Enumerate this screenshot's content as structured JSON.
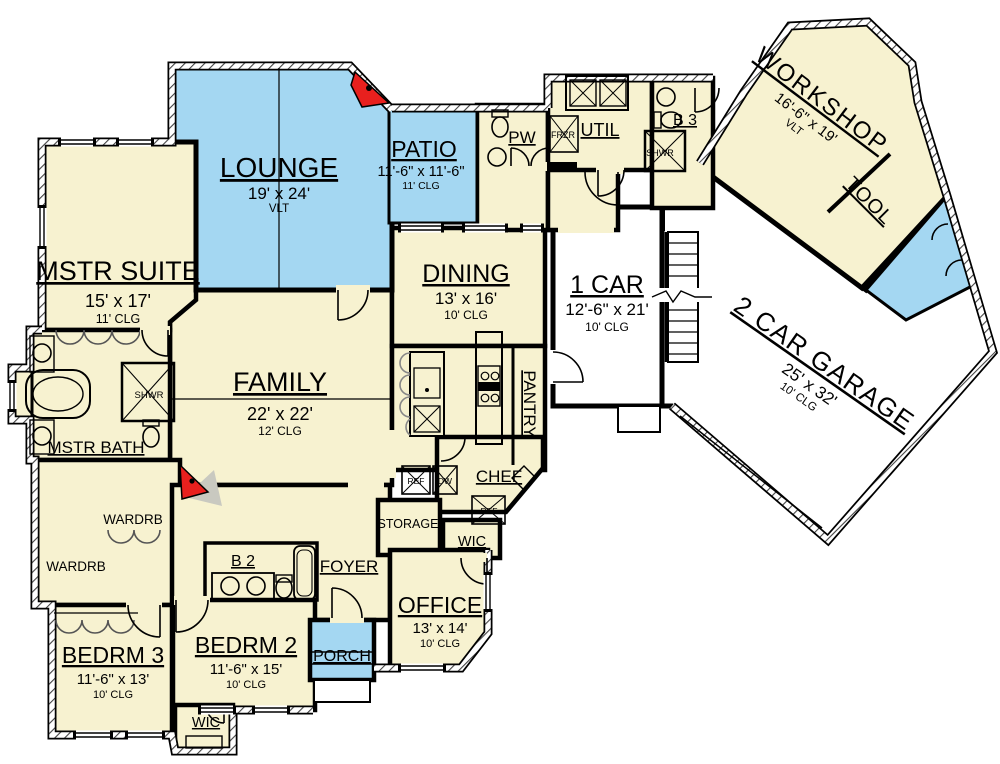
{
  "plan": {
    "title": "First floor plan",
    "rooms": {
      "mstr_suite": {
        "name": "MSTR SUITE",
        "dims": "15' x 17'",
        "clg": "11' CLG"
      },
      "lounge": {
        "name": "LOUNGE",
        "dims": "19' x 24'",
        "clg": "VLT"
      },
      "patio": {
        "name": "PATIO",
        "dims": "11'-6\" x 11'-6\"",
        "clg": "11' CLG"
      },
      "pw": {
        "name": "PW"
      },
      "util": {
        "name": "UTIL"
      },
      "b3": {
        "name": "B 3"
      },
      "shwr_b3": {
        "name": "SHWR"
      },
      "workshop": {
        "name": "WORKSHOP",
        "dims": "16'-6\" x 19'",
        "clg": "VLT"
      },
      "tool": {
        "name": "TOOL"
      },
      "one_car": {
        "name": "1 CAR",
        "dims": "12'-6\" x 21'",
        "clg": "10' CLG"
      },
      "garage": {
        "name": "2 CAR GARAGE",
        "dims": "25' x 32'",
        "clg": "10' CLG"
      },
      "dining": {
        "name": "DINING",
        "dims": "13' x 16'",
        "clg": "10' CLG"
      },
      "family": {
        "name": "FAMILY",
        "dims": "22' x 22'",
        "clg": "12' CLG"
      },
      "pantry": {
        "name": "PANTRY"
      },
      "chef": {
        "name": "CHEF"
      },
      "mstr_bath": {
        "name": "MSTR BATH"
      },
      "shwr_mstr": {
        "name": "SHWR"
      },
      "wardrb_upper": {
        "name": "WARDRB"
      },
      "wardrb_lower": {
        "name": "WARDRB"
      },
      "storage": {
        "name": "STORAGE"
      },
      "wic_office": {
        "name": "WIC"
      },
      "wic_bedrm2": {
        "name": "WIC"
      },
      "b2": {
        "name": "B 2"
      },
      "foyer": {
        "name": "FOYER"
      },
      "office": {
        "name": "OFFICE",
        "dims": "13' x 14'",
        "clg": "10' CLG"
      },
      "porch": {
        "name": "PORCH"
      },
      "bedrm3": {
        "name": "BEDRM 3",
        "dims": "11'-6\" x 13'",
        "clg": "10' CLG"
      },
      "bedrm2": {
        "name": "BEDRM 2",
        "dims": "11'-6\" x 15'",
        "clg": "10' CLG"
      }
    },
    "appliances": {
      "frzr": "FRZR",
      "ref_kitchen": "REF",
      "dw": "DW",
      "ref_chef": "REF"
    },
    "colors": {
      "room_fill": "#F7F2D0",
      "outdoor_fill": "#A4D7F2",
      "garage_fill": "#FFFFFF",
      "wall": "#000000",
      "fireplace": "#E8201E"
    }
  }
}
